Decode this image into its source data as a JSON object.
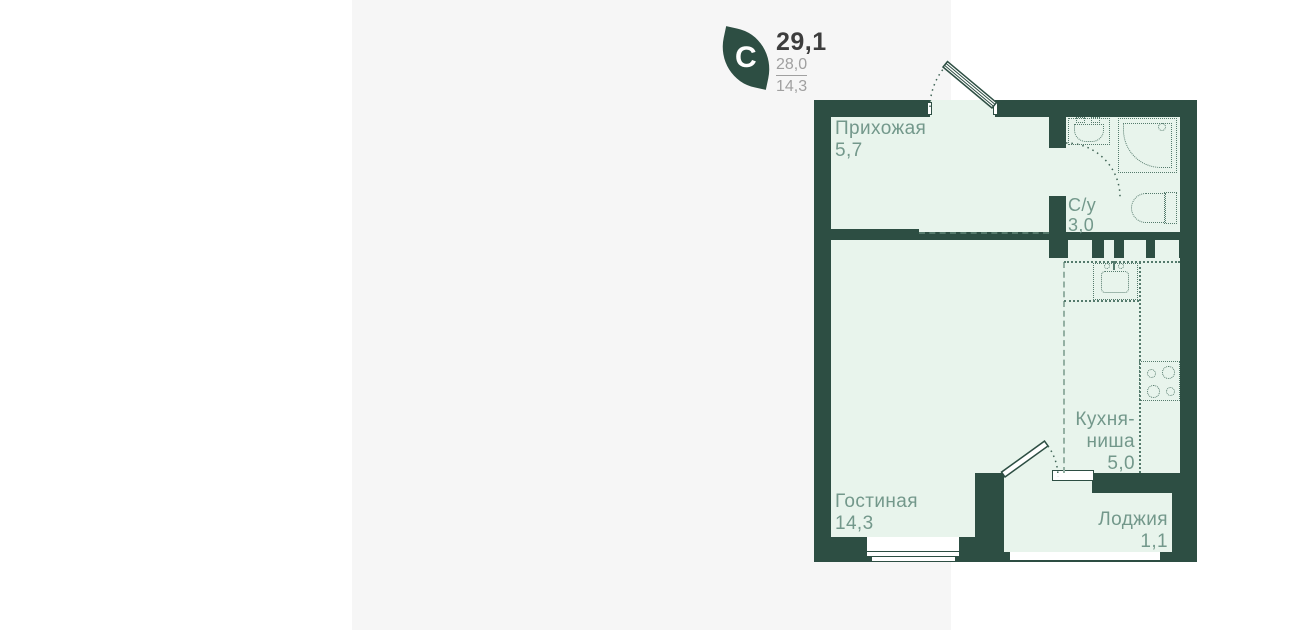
{
  "legend": {
    "logo_letter": "C",
    "total_area": "29,1",
    "area_2": "28,0",
    "area_3": "14,3"
  },
  "rooms": {
    "hallway": {
      "name": "Прихожая",
      "area": "5,7"
    },
    "bathroom": {
      "name": "С/у",
      "area": "3,0"
    },
    "kitchen": {
      "name_line1": "Кухня-",
      "name_line2": "ниша",
      "area": "5,0"
    },
    "living": {
      "name": "Гостиная",
      "area": "14,3"
    },
    "loggia": {
      "name": "Лоджия",
      "area": "1,1"
    }
  },
  "colors": {
    "wall": "#2d4e43",
    "room_fill": "#e8f4ec",
    "card_bg": "#f6f6f6",
    "page_bg": "#ffffff",
    "label_text": "#73988b",
    "area_number_gray": "#a0a0a0",
    "title_text": "#3d3d3d",
    "fixture_line": "#547a6c"
  }
}
